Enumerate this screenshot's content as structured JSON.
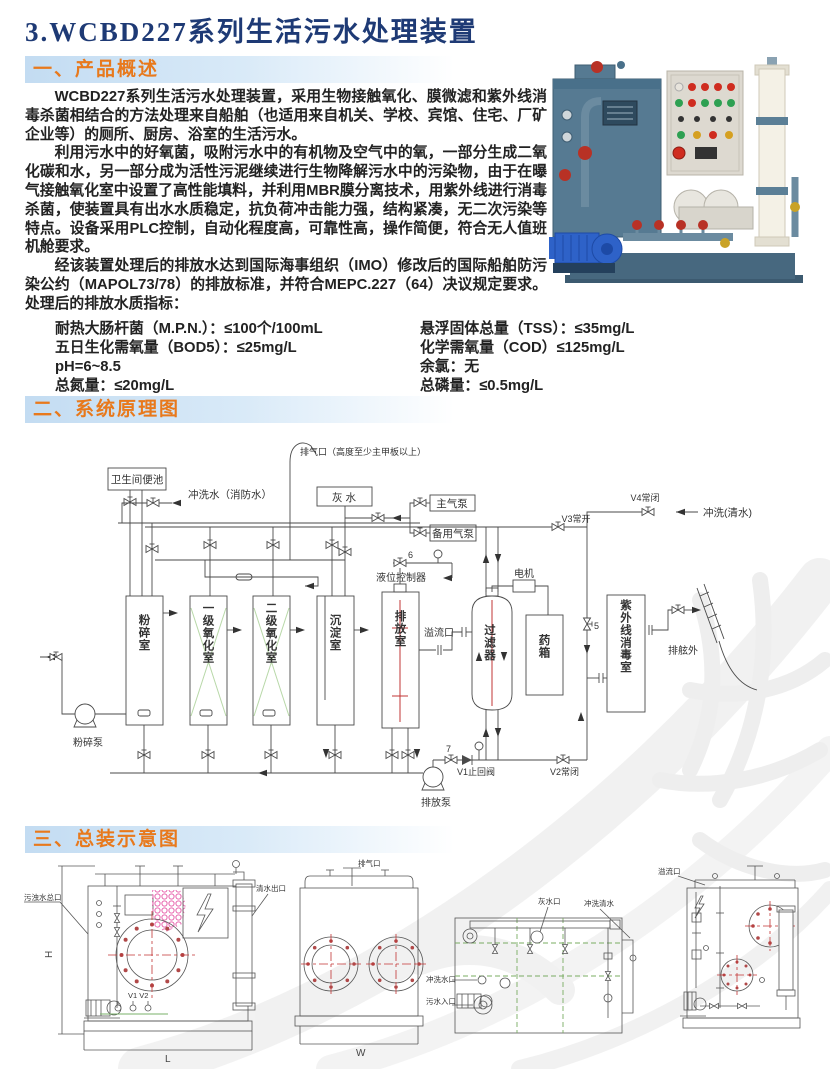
{
  "title": "3.WCBD227系列生活污水处理装置",
  "overview": {
    "heading": "一、产品概述",
    "paragraphs": [
      "WCBD227系列生活污水处理装置，采用生物接触氧化、膜微滤和紫外线消毒杀菌相结合的方法处理来自船舶（也适用来自机关、学校、宾馆、住宅、厂矿企业等）的厕所、厨房、浴室的生活污水。",
      "利用污水中的好氧菌，吸附污水中的有机物及空气中的氧，一部分生成二氧化碳和水，另一部分成为活性污泥继续进行生物降解污水中的污染物，由于在曝气接触氧化室中设置了高性能填料，并利用MBR膜分离技术，用紫外线进行消毒杀菌，使装置具有出水水质稳定，抗负荷冲击能力强，结构紧凑，无二次污染等特点。设备采用PLC控制，自动化程度高，可靠性高，操作简便，符合无人值班机舱要求。",
      "经该装置处理后的排放水达到国际海事组织（IMO）修改后的国际船舶防污染公约（MAPOL73/78）的排放标准，并符合MEPC.227（64）决议规定要求。处理后的排放水质指标："
    ],
    "specs_left": [
      "耐热大肠杆菌（M.P.N.）：≤100个/100mL",
      "五日生化需氧量（BOD5）：≤25mg/L",
      "pH=6~8.5",
      "总氮量：≤20mg/L"
    ],
    "specs_right": [
      "悬浮固体总量（TSS）：≤35mg/L",
      "化学需氧量（COD）≤125mg/L",
      "余氯：无",
      "总磷量：≤0.5mg/L"
    ]
  },
  "schematic": {
    "heading": "二、系统原理图",
    "labels": {
      "vent": "排气口（高度至少主甲板以上）",
      "toilet": "卫生间便池",
      "flush_fire": "冲洗水（消防水）",
      "gray_water": "灰  水",
      "main_air_pump": "主气泵",
      "backup_air_pump": "备用气泵",
      "v4": "V4常闭",
      "flush_clean": "冲洗(清水)",
      "v3": "V3常开",
      "num6": "6",
      "level_controller": "液位控制器",
      "motor": "电机",
      "tank1": "粉碎室",
      "tank2": "一级氧化室",
      "tank3": "二级氧化室",
      "tank4": "沉淀室",
      "tank5": "排放室",
      "overflow": "溢流口",
      "filter": "过滤器",
      "chem_tank": "药箱",
      "uv_chamber": "紫外线消毒室",
      "overboard": "排舷外",
      "num5": "5",
      "crush_pump": "粉碎泵",
      "discharge_pump": "排放泵",
      "num7": "7",
      "v1": "V1止回阀",
      "v2": "V2常闭"
    }
  },
  "assembly": {
    "heading": "三、总装示意图",
    "labels": {
      "dim_h": "H",
      "dim_l": "L",
      "dim_w": "W",
      "inlet_main": "污浊水总口",
      "clean_out": "清水出口",
      "v1v2": "V1  V2",
      "vent": "排气口",
      "gray_port": "灰水口",
      "flush_clean": "冲洗清水",
      "flush_port": "冲洗水口",
      "sewage_in": "污水入口",
      "overflow": "溢流口"
    }
  },
  "colors": {
    "title_blue": "#1e3a75",
    "accent_orange": "#e8791c",
    "bar_blue": "#c3dcf2",
    "diagram_red": "#c23434",
    "diagram_green": "#79ac62",
    "honeycomb_pink": "#e86ab0",
    "machine_body": "#567a92",
    "pump_blue": "#2e62c8"
  }
}
